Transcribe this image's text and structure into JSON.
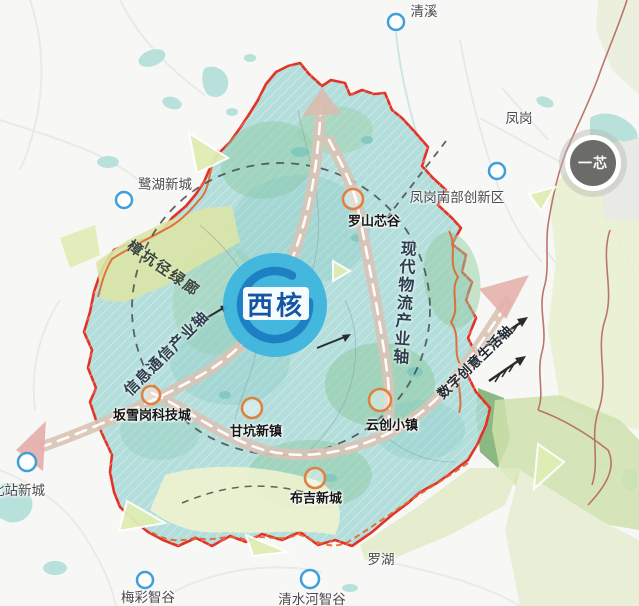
{
  "map": {
    "core_badge": "西核",
    "one_core_badge": "一芯",
    "axes": {
      "info": "信息通信产业轴",
      "logistics": "现代物流产业轴",
      "digital": "数字创意生活轴",
      "greenway": "樟坑径绿廊"
    },
    "nodes": {
      "luoshan": "罗山芯谷",
      "banxuegang": "坂雪岗科技城",
      "gankeng": "甘坑新镇",
      "yunchuang": "云创小镇",
      "buji": "布吉新城"
    },
    "districts": {
      "qingxi": "清溪",
      "fenggang": "凤岗",
      "luhu": "鹭湖新城",
      "fenggang_south": "凤岗南部创新区",
      "beizhan": "北站新城",
      "luohu": "罗湖",
      "meicai": "梅彩智谷",
      "qingshuihe": "清水河智谷"
    },
    "colors": {
      "region_fill": "#a7d9d6",
      "region_border": "#e23326",
      "inner_line": "#e0662e",
      "core_circle": "#3fb5de",
      "core_ring": "#1d80c3",
      "core_text": "#1356a4",
      "road": "#d9c3b5",
      "road_arrow": "#e6aeaa",
      "node_orange": "#df8140",
      "node_blue": "#3f9fd8",
      "greenway_fill": "#dae6a6",
      "one_core_fill": "#6b6b68",
      "outer_boundary": "#b4695f"
    }
  }
}
